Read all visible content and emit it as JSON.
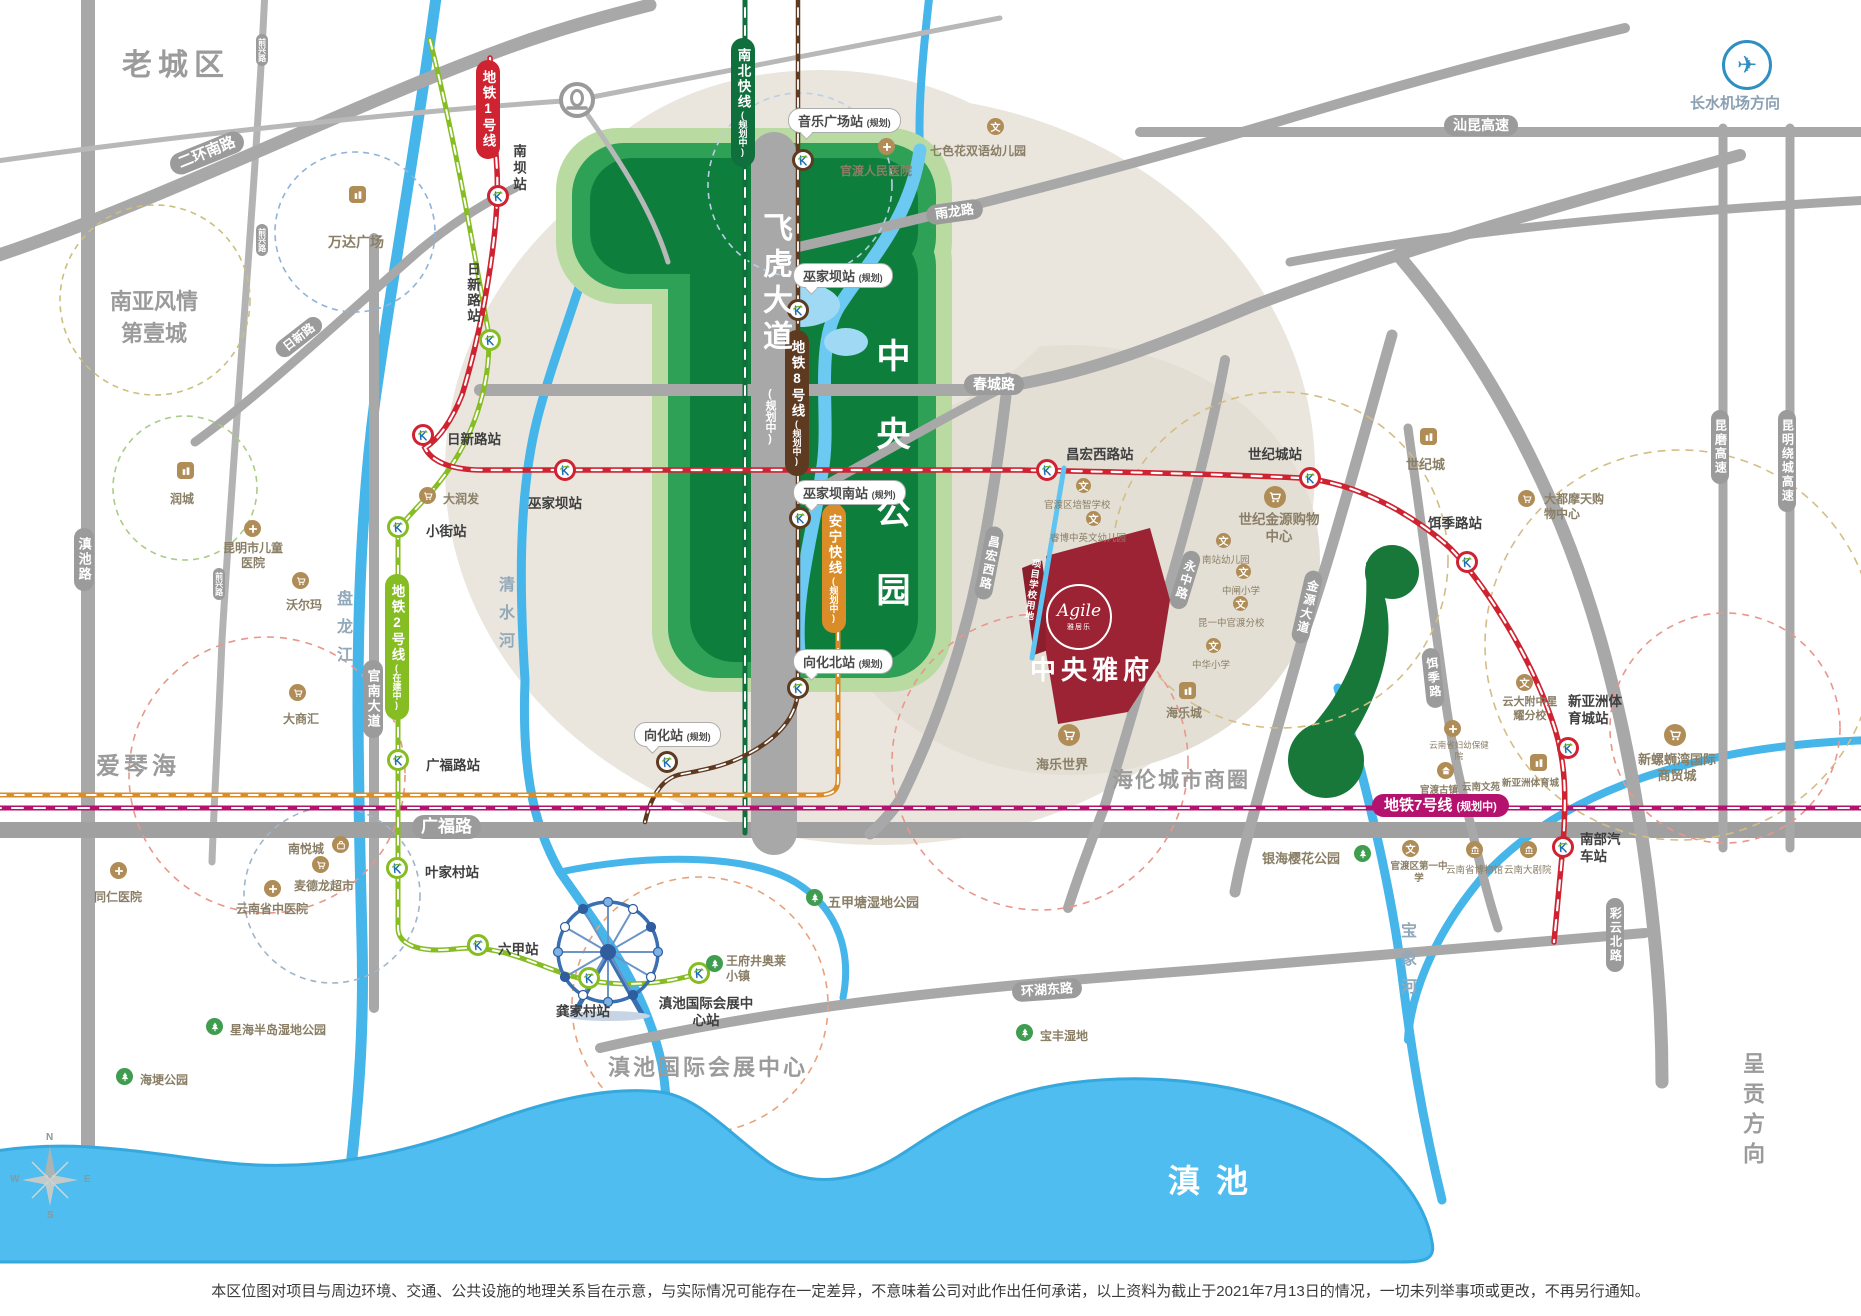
{
  "project": {
    "name": "中央雅府",
    "logo": "Agile",
    "logo_sub": "雅居乐",
    "land_note": "项目学校用地"
  },
  "disclaimer": "本区位图对项目与周边环境、交通、公共设施的地理关系旨在示意，与实际情况可能存在一定差异，不意味着公司对此作出任何承诺，以上资料为截止于2021年7月13日的情况，一切未列举事项或更改，不再另行通知。",
  "compass": {
    "n": "N",
    "e": "E",
    "s": "S",
    "w": "W"
  },
  "areas": [
    "老城区",
    "南亚风情第壹城",
    "爱琴海",
    "海伦城市商圈",
    "滇池国际会展中心",
    "滇池",
    "呈贡方向",
    "长水机场方向",
    "中央公园",
    "飞虎大道",
    "(规划中)"
  ],
  "rivers": [
    "清水河",
    "盘龙江",
    "宝象河"
  ],
  "road_pills": [
    "二环南路",
    "滇池路",
    "前兴路",
    "前兴路",
    "前兴路",
    "日新路",
    "官南大道",
    "广福路",
    "雨龙路",
    "春城路",
    "昌宏西路",
    "永中路",
    "金源大道",
    "饵季路",
    "环湖东路",
    "彩云北路",
    "汕昆高速",
    "昆磨高速",
    "昆明绕城高速"
  ],
  "metro_pills": [
    {
      "label": "地铁1号线",
      "sub": ""
    },
    {
      "label": "地铁2号线",
      "sub": "(在建中)"
    },
    {
      "label": "南北快线",
      "sub": "(规划中)"
    },
    {
      "label": "地铁8号线",
      "sub": "(规划中)"
    },
    {
      "label": "安宁快线",
      "sub": "(规划中)"
    },
    {
      "label": "地铁7号线",
      "sub": "(规划中)"
    }
  ],
  "stations": [
    "南坝站",
    "日新路站",
    "日新路站",
    "小街站",
    "广福路站",
    "叶家村站",
    "六甲站",
    "龚家村站",
    "滇池国际会展中心站",
    "巫家坝站",
    "昌宏西路站",
    "世纪城站",
    "饵季路站",
    "新亚洲体育城站",
    "南部汽车站"
  ],
  "callouts": [
    {
      "name": "音乐广场站",
      "tag": "(规划)"
    },
    {
      "name": "巫家坝站",
      "tag": "(规划)"
    },
    {
      "name": "巫家坝南站",
      "tag": "(规划)"
    },
    {
      "name": "向化北站",
      "tag": "(规划)"
    },
    {
      "name": "向化站",
      "tag": "(规划)"
    }
  ],
  "pois": [
    "万达广场",
    "润城",
    "昆明市儿童医院",
    "沃尔玛",
    "大润发",
    "大商汇",
    "同仁医院",
    "南悦城",
    "麦德龙超市",
    "云南省中医院",
    "王府井奥莱小镇",
    "五甲塘湿地公园",
    "海埂公园",
    "星海半岛湿地公园",
    "宝丰湿地",
    "银海樱花公园",
    "官渡区第一中学",
    "云南省博物馆",
    "云南大剧院",
    "官渡古镇",
    "云南省妇幼保健院",
    "云南文苑",
    "新亚洲体育城",
    "新螺蛳湾国际商贸城",
    "云大附中星耀分校",
    "大都摩天购物中心",
    "世纪金源购物中心",
    "世纪城",
    "官渡区培智学校",
    "睿博中英文幼儿园",
    "南站幼儿园",
    "中闸小学",
    "昆一中官渡分校",
    "中华小学",
    "海乐城",
    "海乐世界",
    "官渡人民医院",
    "七色花双语幼儿园"
  ]
}
